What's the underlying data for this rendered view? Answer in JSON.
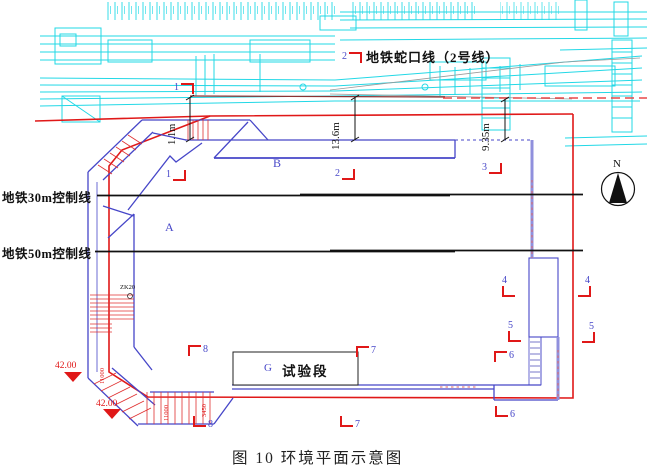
{
  "figure": {
    "caption": "图 10 环境平面示意图"
  },
  "labels": {
    "metro_line": "地铁蛇口线（2号线）",
    "control_line_30m": "地铁30m控制线",
    "control_line_50m": "地铁50m控制线",
    "region_a": "A",
    "region_b": "B",
    "region_g": "G",
    "test_section": "试验段",
    "north": "N"
  },
  "dimensions": {
    "offset_1": "1.1m",
    "offset_2": "13.6m",
    "offset_3": "9.35m",
    "small_1": "11000",
    "small_2": "11000",
    "small_3": "3450",
    "borehole": "ZK20"
  },
  "elevations": {
    "spot_1": "42.00",
    "spot_2": "42.00"
  },
  "markers": {
    "m1t": "1",
    "m1m": "1",
    "m2t": "2",
    "m2m": "2",
    "m3": "3",
    "m4l": "4",
    "m4r": "4",
    "m5l": "5",
    "m5r": "5",
    "m6m": "6",
    "m6b": "6",
    "m7t": "7",
    "m7b": "7",
    "m8t": "8",
    "m8b": "8"
  },
  "colors": {
    "cad_cyan": "#22d8e6",
    "outline_blue": "#4646c8",
    "wall_lavender": "#9090dd",
    "boundary_red": "#e01818",
    "control_line_black": "#111111"
  }
}
